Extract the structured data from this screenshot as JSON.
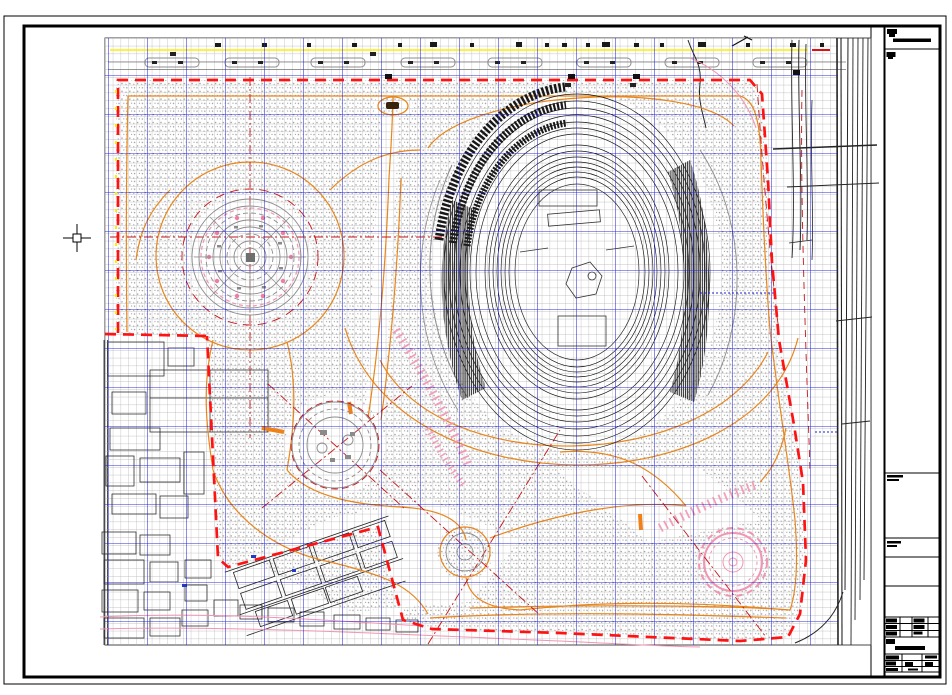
{
  "app": {
    "type": "cad-drawing-viewer",
    "document_kind": "site-plan-sheet",
    "background": "#ffffff"
  },
  "colors": {
    "frame": "#000000",
    "grid_minor": "#b2b2b2",
    "grid_major": "#1a1ad6",
    "stipple": "#9c9c9c",
    "yellow": "#ffee00",
    "red_boundary": "#ff1212",
    "red_thin": "#c81414",
    "orange": "#e8861c",
    "orange_thick": "#f08018",
    "pink": "#f295b2",
    "pink_dot": "#ef7da6",
    "gray_line": "#8c8c8c",
    "black_line": "#242424"
  },
  "sheet": {
    "outer_border": "thin",
    "inner_border": "thick",
    "title_block": {
      "position": "right-column",
      "sections": [
        {
          "name": "header-with-rule",
          "text_legible": false
        },
        {
          "name": "notes-area-large",
          "text_legible": false
        },
        {
          "name": "label-strip-1",
          "text_legible": false
        },
        {
          "name": "label-strip-2",
          "text_legible": false
        },
        {
          "name": "empty-box-1",
          "text_legible": false
        },
        {
          "name": "empty-box-2",
          "text_legible": false
        },
        {
          "name": "revision-table",
          "rows": 3,
          "cols": 4,
          "text_legible": false
        },
        {
          "name": "stamp-with-bar",
          "text_legible": false
        },
        {
          "name": "signature-table",
          "rows": 3,
          "cols": 4,
          "text_legible": false
        }
      ]
    }
  },
  "drawing": {
    "grid": {
      "minor_spacing_px": 7.8,
      "major_spacing_px": 39
    },
    "features": [
      "site-boundary-red-dashed",
      "park-stipple-texture",
      "stadium-oval",
      "circular-fountain-plaza",
      "tree-plaza",
      "roundabout",
      "flower-plaza",
      "orange-path-network",
      "pink-stair-paths",
      "existing-urban-blocks",
      "diagonal-street-blocks",
      "right-road-corridor",
      "top-street-strip",
      "pond-feature"
    ]
  },
  "cursor": {
    "kind": "crosshair-pickbox",
    "x": 77,
    "y": 238
  }
}
